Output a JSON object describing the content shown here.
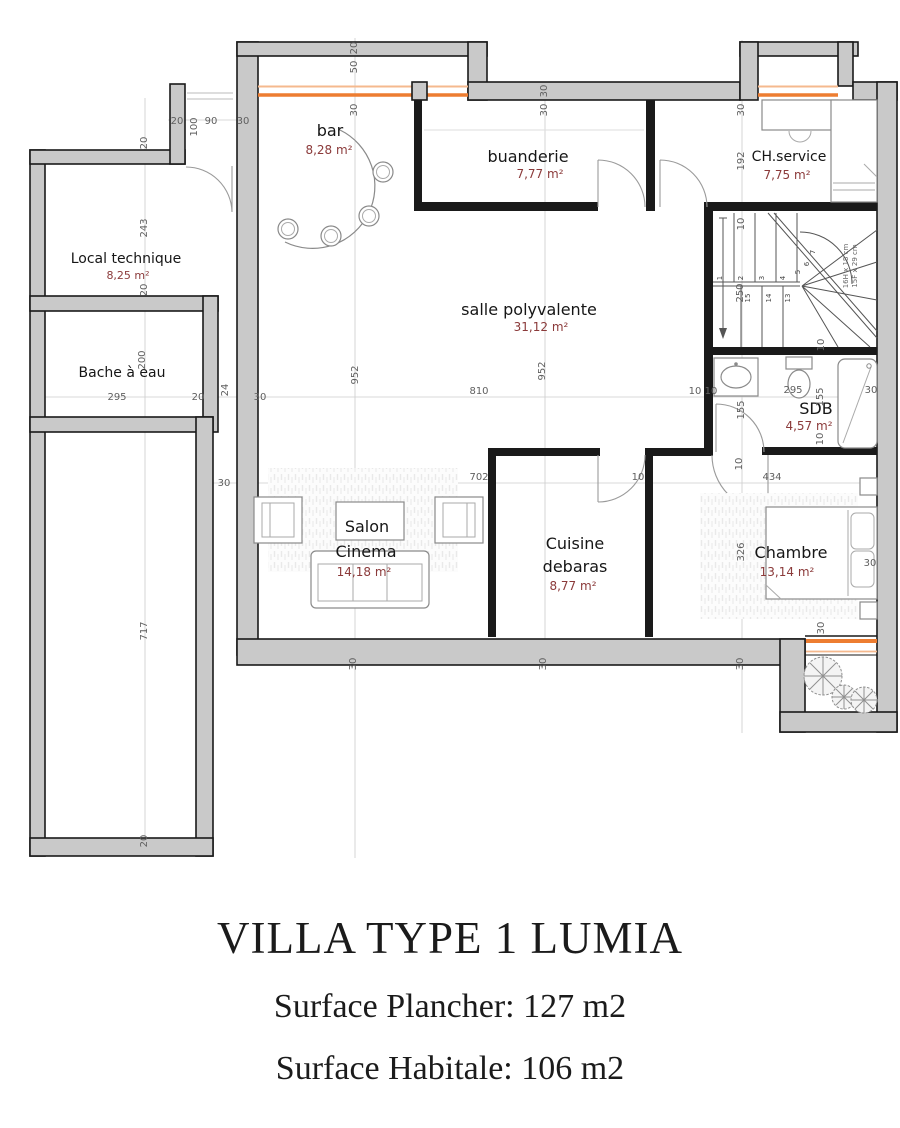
{
  "title_block": {
    "line1": "VILLA TYPE 1 LUMIA",
    "line2": "Surface Plancher: 127 m2",
    "line3": "Surface Habitale: 106 m2"
  },
  "rooms": {
    "bar": {
      "name": "bar",
      "area": "8,28 m²"
    },
    "buanderie": {
      "name": "buanderie",
      "area": "7,77 m²"
    },
    "ch_service": {
      "name": "CH.service",
      "area": "7,75 m²"
    },
    "salle": {
      "name": "salle polyvalente",
      "area": "31,12 m²"
    },
    "local_technique": {
      "name": "Local technique",
      "area": "8,25 m²"
    },
    "bache": {
      "name": "Bache à eau"
    },
    "sdb": {
      "name": "SDB",
      "area": "4,57 m²"
    },
    "salon": {
      "name_line1": "Salon",
      "name_line2": "Cinema",
      "area": "14,18 m²"
    },
    "cuisine": {
      "name_line1": "Cuisine",
      "name_line2": "debaras",
      "area": "8,77 m²"
    },
    "chambre": {
      "name": "Chambre",
      "area": "13,14 m²"
    }
  },
  "stairs": {
    "note_line1": "16H x 18 cm",
    "note_line2": "15F x 29 cm",
    "steps": [
      {
        "t": "1",
        "x": 722,
        "y": 278
      },
      {
        "t": "2",
        "x": 743,
        "y": 278
      },
      {
        "t": "3",
        "x": 764,
        "y": 278
      },
      {
        "t": "4",
        "x": 785,
        "y": 278
      },
      {
        "t": "5",
        "x": 800,
        "y": 272
      },
      {
        "t": "6",
        "x": 809,
        "y": 264
      },
      {
        "t": "7",
        "x": 815,
        "y": 252
      },
      {
        "t": "15",
        "x": 750,
        "y": 298
      },
      {
        "t": "14",
        "x": 771,
        "y": 298
      },
      {
        "t": "13",
        "x": 790,
        "y": 298
      }
    ]
  },
  "dimensions": [
    {
      "t": "20",
      "x": 357,
      "y": 48,
      "r": 1
    },
    {
      "t": "50",
      "x": 357,
      "y": 67,
      "r": 1
    },
    {
      "t": "30",
      "x": 357,
      "y": 110,
      "r": 1
    },
    {
      "t": "30",
      "x": 547,
      "y": 91,
      "r": 1
    },
    {
      "t": "30",
      "x": 547,
      "y": 110,
      "r": 1
    },
    {
      "t": "30",
      "x": 744,
      "y": 110,
      "r": 1
    },
    {
      "t": "192",
      "x": 744,
      "y": 161,
      "r": 1
    },
    {
      "t": "20",
      "x": 177,
      "y": 124
    },
    {
      "t": "100",
      "x": 197,
      "y": 127,
      "r": 1
    },
    {
      "t": "90",
      "x": 211,
      "y": 124
    },
    {
      "t": "30",
      "x": 243,
      "y": 124
    },
    {
      "t": "20",
      "x": 147,
      "y": 143,
      "r": 1
    },
    {
      "t": "243",
      "x": 147,
      "y": 228,
      "r": 1
    },
    {
      "t": "20",
      "x": 147,
      "y": 290,
      "r": 1
    },
    {
      "t": "200",
      "x": 145,
      "y": 360,
      "r": 1
    },
    {
      "t": "295",
      "x": 117,
      "y": 400
    },
    {
      "t": "20",
      "x": 198,
      "y": 400
    },
    {
      "t": "24",
      "x": 228,
      "y": 390,
      "r": 1
    },
    {
      "t": "30",
      "x": 260,
      "y": 400
    },
    {
      "t": "952",
      "x": 358,
      "y": 375,
      "r": 1
    },
    {
      "t": "952",
      "x": 545,
      "y": 371,
      "r": 1
    },
    {
      "t": "810",
      "x": 479,
      "y": 394
    },
    {
      "t": "10",
      "x": 695,
      "y": 394
    },
    {
      "t": "10",
      "x": 711,
      "y": 394
    },
    {
      "t": "295",
      "x": 793,
      "y": 393
    },
    {
      "t": "155",
      "x": 823,
      "y": 397,
      "r": 1
    },
    {
      "t": "30",
      "x": 871,
      "y": 393
    },
    {
      "t": "155",
      "x": 744,
      "y": 410,
      "r": 1
    },
    {
      "t": "10",
      "x": 823,
      "y": 439,
      "r": 1
    },
    {
      "t": "10",
      "x": 742,
      "y": 464,
      "r": 1
    },
    {
      "t": "10",
      "x": 744,
      "y": 224,
      "r": 1
    },
    {
      "t": "250",
      "x": 743,
      "y": 293,
      "r": 1
    },
    {
      "t": "10",
      "x": 824,
      "y": 345,
      "r": 1
    },
    {
      "t": "30",
      "x": 224,
      "y": 486
    },
    {
      "t": "702",
      "x": 479,
      "y": 480
    },
    {
      "t": "10",
      "x": 638,
      "y": 480
    },
    {
      "t": "434",
      "x": 772,
      "y": 480
    },
    {
      "t": "326",
      "x": 744,
      "y": 552,
      "r": 1
    },
    {
      "t": "30",
      "x": 870,
      "y": 566
    },
    {
      "t": "30",
      "x": 824,
      "y": 628,
      "r": 1
    },
    {
      "t": "30",
      "x": 356,
      "y": 664,
      "r": 1
    },
    {
      "t": "30",
      "x": 546,
      "y": 664,
      "r": 1
    },
    {
      "t": "30",
      "x": 743,
      "y": 664,
      "r": 1
    },
    {
      "t": "717",
      "x": 147,
      "y": 631,
      "r": 1
    },
    {
      "t": "20",
      "x": 147,
      "y": 841,
      "r": 1
    }
  ],
  "colors": {
    "wall_fill": "#c9c9c9",
    "wall_edge": "#1a1a1a",
    "window_orange": "#ed7d31",
    "window_orange_light": "#f5b98e",
    "room_text": "#161616",
    "area_text": "#8b3a3a",
    "dim_text": "#5f5f5f"
  }
}
